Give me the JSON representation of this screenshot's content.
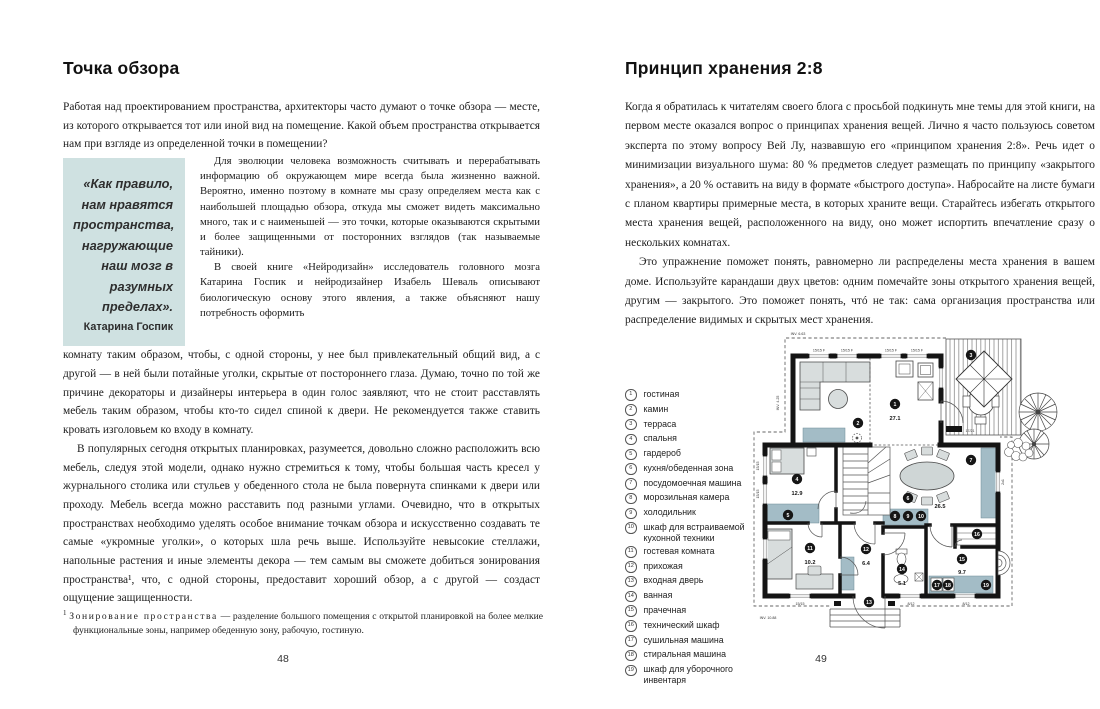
{
  "colors": {
    "quote_bg": "#cfe1e1",
    "plan_accent": "#a3bcc6",
    "wall": "#141414"
  },
  "left_page": {
    "title": "Точка обзора",
    "page_number": "48",
    "paragraphs": {
      "p1": "Работая над проектированием пространства, архитекторы часто думают о точке обзора — месте, из которого открывается тот или иной вид на помещение. Какой объем пространства открывается нам при взгляде из определенной точки в помещении?",
      "p2": "Для эволюции человека возможность считывать и перерабатывать информацию об окружающем мире всегда была жизненно важной. Вероятно, именно поэтому в комнате мы сразу определяем места как с наибольшей площадью обзора, откуда мы сможет видеть максимально много, так и с наименьшей — это точки, которые оказываются скрытыми и более защищенными от посторонних взглядов (так называемые тайники).",
      "p3_side": "В своей книге «Нейродизайн» исследователь головного мозга Катарина Госпик и нейродизайнер Изабель Шеваль описывают биологическую основу этого явления, а также объясняют нашу потребность оформить",
      "p3_rest": "комнату таким образом, чтобы, с одной стороны, у нее был привлекательный общий вид, а с другой — в ней были потайные уголки, скрытые от постороннего глаза. Думаю, точно по той же причине декораторы и дизайнеры интерьера в один голос заявляют, что не стоит расставлять мебель таким образом, чтобы кто-то сидел спиной к двери. Не рекомендуется также ставить кровать изголовьем ко входу в комнату.",
      "p4": "В популярных сегодня открытых планировках, разумеется, довольно сложно расположить всю мебель, следуя этой модели, однако нужно стремиться к тому, чтобы большая часть кресел у журнального столика или стульев у обеденного стола не была повернута спинками к двери или проходу. Мебель всегда можно расставить под разными углами. Очевидно, что в открытых пространствах необходимо уделять особое внимание точкам обзора и искусственно создавать те самые «укромные уголки», о которых шла речь выше. Используйте невысокие стеллажи, напольные растения и иные элементы декора — тем самым вы сможете добиться зонирования пространства¹, что, с одной стороны, предоставит хороший обзор, а с другой — создаст ощущение защищенности."
    },
    "quote": {
      "text": "«Как правило, нам нравятся пространства, нагружающие наш мозг в разумных пределах».",
      "author": "Катарина Госпик"
    },
    "footnote": {
      "marker": "1",
      "term": "Зонирование пространства",
      "text": " — разделение большого помещения с открытой планировкой на более мелкие функциональные зоны, например обеденную зону, рабочую, гостиную."
    }
  },
  "right_page": {
    "title": "Принцип хранения 2:8",
    "page_number": "49",
    "paragraphs": {
      "p1": "Когда я обратилась к читателям своего блога с просьбой подкинуть мне темы для этой книги, на первом месте оказался вопрос о принципах хранения вещей. Лично я часто пользуюсь советом эксперта по этому вопросу Вей Лу, назвавшую его «принципом хранения 2:8». Речь идет о минимизации визуального шума: 80 % предметов следует размещать по принципу «закрытого хранения», а 20 % оставить на виду в формате «быстрого доступа». Набросайте на листе бумаги с планом квартиры примерные места, в которых храните вещи. Старайтесь избегать открытого места хранения вещей, расположенного на виду, оно может испортить впечатление сразу о нескольких комнатах.",
      "p2": "Это упражнение поможет понять, равномерно ли распределены места хранения в вашем доме. Используйте карандаши двух цветов: одним помечайте зоны открытого хранения вещей, другим — закрытого. Это поможет понять, чтó не так: сама организация пространства или распределение видимых и скрытых мест хранения."
    },
    "legend": [
      {
        "num": "1",
        "label": "гостиная"
      },
      {
        "num": "2",
        "label": "камин"
      },
      {
        "num": "3",
        "label": "терраса"
      },
      {
        "num": "4",
        "label": "спальня"
      },
      {
        "num": "5",
        "label": "гардероб"
      },
      {
        "num": "6",
        "label": "кухня/обеденная зона"
      },
      {
        "num": "7",
        "label": "посудомоечная машина"
      },
      {
        "num": "8",
        "label": "морозильная камера"
      },
      {
        "num": "9",
        "label": "холодильник"
      },
      {
        "num": "10",
        "label": "шкаф для встраиваемой кухонной техники"
      },
      {
        "num": "11",
        "label": "гостевая комната"
      },
      {
        "num": "12",
        "label": "прихожая"
      },
      {
        "num": "13",
        "label": "входная дверь"
      },
      {
        "num": "14",
        "label": "ванная"
      },
      {
        "num": "15",
        "label": "прачечная"
      },
      {
        "num": "16",
        "label": "технический шкаф"
      },
      {
        "num": "17",
        "label": "сушильная машина"
      },
      {
        "num": "18",
        "label": "стиральная машина"
      },
      {
        "num": "19",
        "label": "шкаф для уборочного инвентаря"
      }
    ],
    "plan": {
      "markers": [
        {
          "n": "1",
          "x": 145,
          "y": 79,
          "area": "27.1",
          "ax": 145,
          "ay": 95
        },
        {
          "n": "2",
          "x": 108,
          "y": 98
        },
        {
          "n": "3",
          "x": 221,
          "y": 30
        },
        {
          "n": "4",
          "x": 47,
          "y": 154,
          "area": "12.9",
          "ax": 47,
          "ay": 170
        },
        {
          "n": "5",
          "x": 38,
          "y": 190
        },
        {
          "n": "6",
          "x": 158,
          "y": 173,
          "area": "26.5",
          "ax": 190,
          "ay": 183
        },
        {
          "n": "7",
          "x": 221,
          "y": 135
        },
        {
          "n": "8",
          "x": 145,
          "y": 191
        },
        {
          "n": "9",
          "x": 158,
          "y": 191
        },
        {
          "n": "10",
          "x": 171,
          "y": 191
        },
        {
          "n": "11",
          "x": 60,
          "y": 223,
          "area": "10.2",
          "ax": 60,
          "ay": 239
        },
        {
          "n": "12",
          "x": 116,
          "y": 224,
          "area": "6.4",
          "ax": 116,
          "ay": 240
        },
        {
          "n": "13",
          "x": 119,
          "y": 277
        },
        {
          "n": "14",
          "x": 152,
          "y": 244,
          "area": "5.1",
          "ax": 152,
          "ay": 260
        },
        {
          "n": "15",
          "x": 212,
          "y": 234,
          "area": "9.7",
          "ax": 212,
          "ay": 249
        },
        {
          "n": "16",
          "x": 227,
          "y": 209
        },
        {
          "n": "17",
          "x": 187,
          "y": 260
        },
        {
          "n": "18",
          "x": 198,
          "y": 260
        },
        {
          "n": "19",
          "x": 236,
          "y": 260
        }
      ],
      "annotations": [
        {
          "t": "INV. 6.63",
          "x": 48,
          "y": 10,
          "s": 4
        },
        {
          "t": "INV. 4.25",
          "x": 29,
          "y": 78,
          "s": 4,
          "r": -90
        },
        {
          "t": "INV. 10.88",
          "x": 18,
          "y": 294,
          "s": 4
        },
        {
          "t": "15/15 F",
          "x": 69,
          "y": 26.5
        },
        {
          "t": "15/15 F",
          "x": 97,
          "y": 26.5
        },
        {
          "t": "15/15 F",
          "x": 141,
          "y": 26.5
        },
        {
          "t": "15/15 F",
          "x": 167,
          "y": 26.5
        },
        {
          "t": "17/21",
          "x": 220,
          "y": 107,
          "s": 3
        },
        {
          "t": "15/15",
          "x": 50,
          "y": 280
        },
        {
          "t": "8/12",
          "x": 161,
          "y": 280
        },
        {
          "t": "8/12",
          "x": 216,
          "y": 280
        },
        {
          "t": "15/15",
          "x": 9,
          "y": 141,
          "r": -90
        },
        {
          "t": "15/15",
          "x": 9,
          "y": 169,
          "r": -90
        },
        {
          "t": "2x1",
          "x": 254,
          "y": 157,
          "r": -90
        }
      ]
    }
  }
}
